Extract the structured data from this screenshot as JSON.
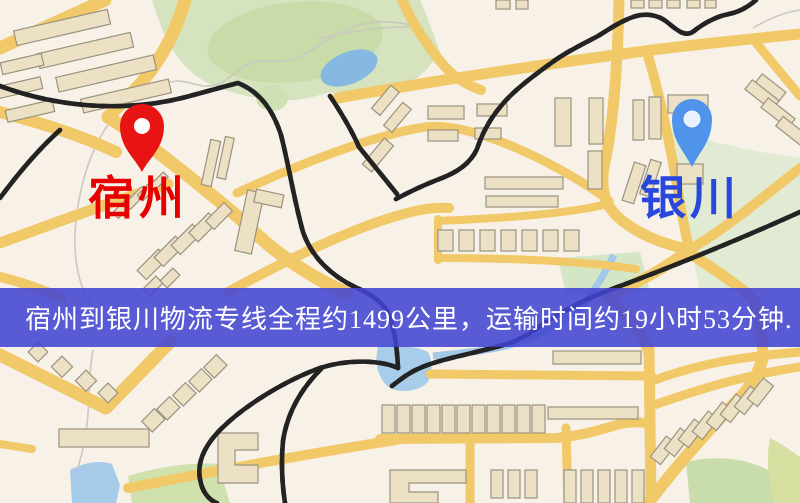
{
  "map": {
    "origin": {
      "label": "宿州",
      "pin_color": "#e81414",
      "pin_hole_color": "#ffffff",
      "label_color": "#e60000"
    },
    "destination": {
      "label": "银川",
      "pin_color": "#4f94ea",
      "pin_hole_color": "#e8f1fc",
      "label_color": "#2747dd"
    }
  },
  "banner": {
    "text": "宿州到银川物流专线全程约1499公里，运输时间约19小时53分钟.",
    "bg_color": "#4244d2",
    "text_color": "#ffffff"
  },
  "route": {
    "origin": "宿州",
    "destination": "银川",
    "distance_km": "1499",
    "duration": "19小时53分钟"
  },
  "palette": {
    "map_background": "#f7f1e8",
    "road": "#f2c968",
    "park_green": "#d5e3bf",
    "water_blue": "#a8cdea",
    "railway": "#232323",
    "building_fill": "#ece1c4"
  }
}
